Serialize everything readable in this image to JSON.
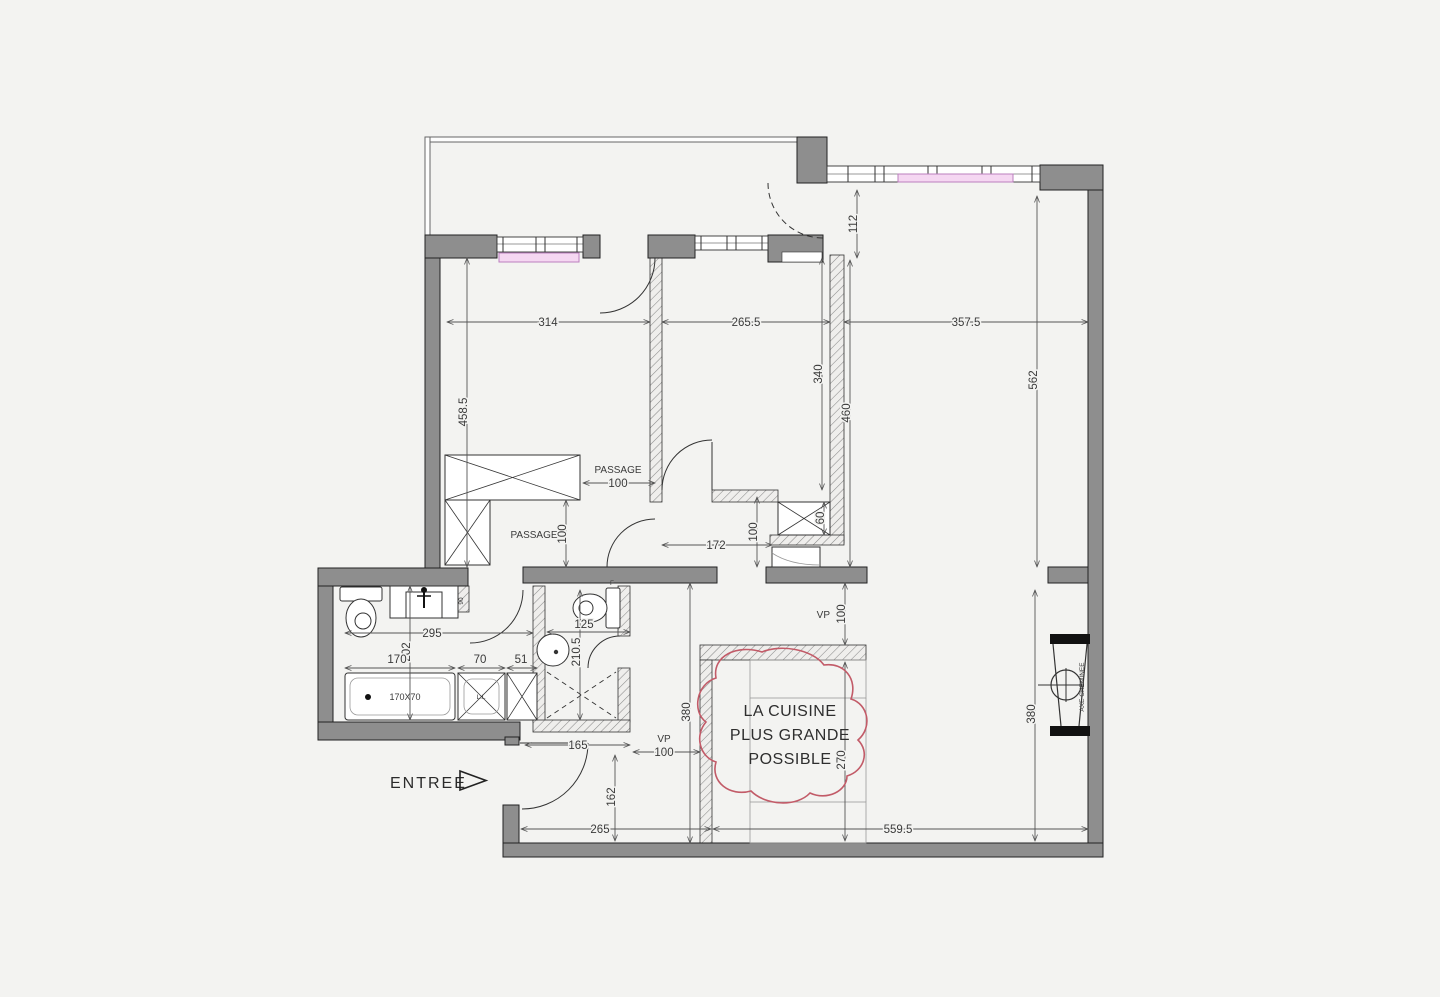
{
  "document": {
    "type": "architectural-floor-plan",
    "background": "#f3f3f1"
  },
  "labels": {
    "entree": "ENTREE",
    "cloud_line1": "LA CUISINE",
    "cloud_line2": "PLUS GRANDE",
    "cloud_line3": "POSSIBLE",
    "passage": "PASSAGE",
    "vp": "VP",
    "axe_cheminee": "AXE CHEMINEE",
    "bathtub_size": "170X70",
    "washer": "L.L",
    "duct": "90",
    "wc_marker": "F"
  },
  "dims": {
    "d314": "314",
    "d265_5": "265.5",
    "d357_5": "357.5",
    "d458_5": "458.5",
    "d340": "340",
    "d460": "460",
    "d562": "562",
    "d112": "112",
    "d100": "100",
    "d172": "172",
    "d60": "60",
    "d380": "380",
    "d270": "270",
    "d559_5": "559.5",
    "d165": "165",
    "d162": "162",
    "d265": "265",
    "d295": "295",
    "d202": "202",
    "d170": "170",
    "d70": "70",
    "d51": "51",
    "d125": "125",
    "d210_5": "210.5"
  },
  "colors": {
    "wall_gray": "#8e8e8e",
    "annotation_red": "#c25b68",
    "radiator_fill": "#f5d7f2",
    "radiator_stroke": "#bb7fbe",
    "line_dark": "#3a3a3a",
    "background": "#f3f3f1"
  }
}
